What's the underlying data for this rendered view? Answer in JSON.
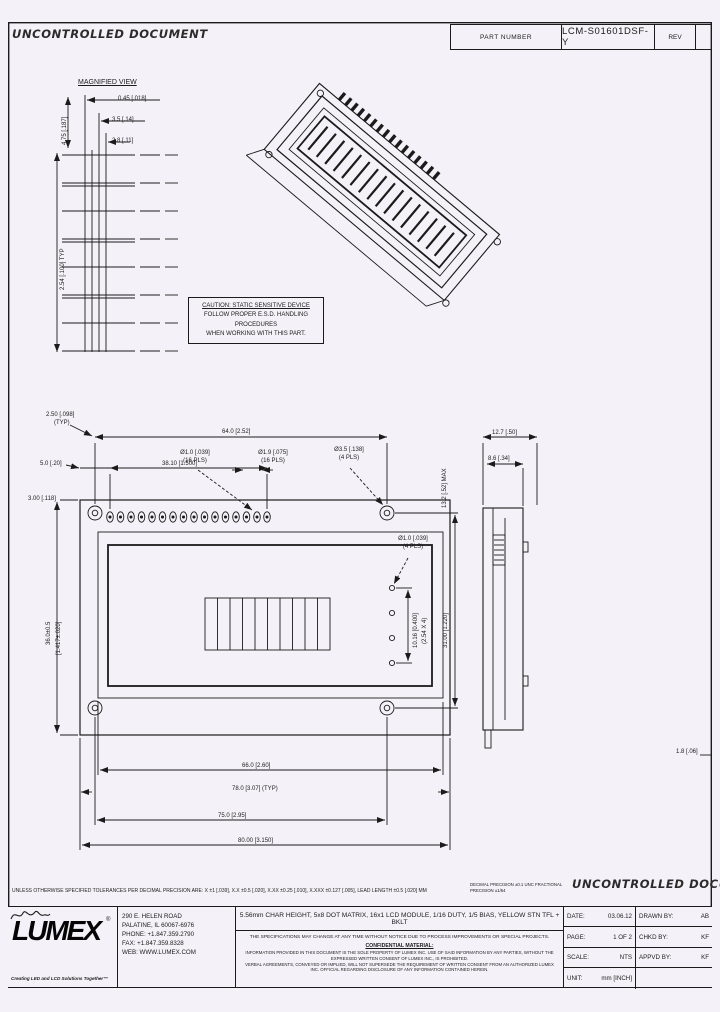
{
  "header": {
    "watermark": "UNCONTROLLED DOCUMENT",
    "part_number_label": "PART NUMBER",
    "part_number": "LCM-S01601DSF-Y",
    "rev_label": "REV",
    "rev_value": ""
  },
  "detail_view": {
    "title": "MAGNIFIED VIEW",
    "dim_pin_width": "0.45 [.018]",
    "dim_pin_a": "3.5 [.14]",
    "dim_pin_b": "2.8 [.11]",
    "dim_left_v": "4.75 [.187]",
    "dim_pitch_v": "2.54 [.100] TYP"
  },
  "caution": {
    "line1": "CAUTION: STATIC SENSITIVE DEVICE",
    "line2": "FOLLOW PROPER E.S.D. HANDLING PROCEDURES",
    "line3": "WHEN WORKING WITH THIS PART."
  },
  "front_view": {
    "dim_hole_offset": "2.50 [.098]",
    "dim_hole_offset_qty": "(TYP)",
    "dim_top_span": "64.0 [2.52]",
    "dim_pin1_offset": "5.0 [.20]",
    "dim_pin_row": "38.10 [1.500]",
    "dim_pin_hole": "Ø1.0 [.039]",
    "dim_pin_hole_qty": "(16 PLS)",
    "dim_pin_pad": "Ø1.9 [.075]",
    "dim_pin_pad_qty": "(16 PLS)",
    "dim_mount_hole": "Ø3.5 [.138]",
    "dim_mount_hole_qty": "(4 PLS)",
    "dim_thickness": "13.2 [.52] MAX",
    "dim_edge": "3.00 [.118]",
    "dim_height_a": "36.0±0.5",
    "dim_height_b": "[1.417±.020]",
    "dim_small_hole": "Ø1.0 [.039]",
    "dim_small_hole_qty": "(4 PLS)",
    "dim_hole_col_a": "10.16 [0.400]",
    "dim_hole_col_b": "(2.54 X 4)",
    "dim_hole_span_v": "31.00 [1.220]",
    "dim_bezel_w": "66.0 [2.60]",
    "dim_typ_w": "78.0 [3.07] (TYP)",
    "dim_hole_span_h": "75.0 [2.95]",
    "dim_overall_w": "80.00 [3.150]"
  },
  "side_view": {
    "dim_total_t": "12.7 [.50]",
    "dim_bezel_t": "8.6 [.34]",
    "dim_pcb_t": "1.8 [.06]"
  },
  "notes": {
    "tolerance": "UNLESS OTHERWISE SPECIFIED TOLERANCES PER DECIMAL PRECISION ARE: X ±1 [.039], X.X ±0.5 [.020], X.XX ±0.25 [.010], X.XXX ±0.127 [.005], LEAD LENGTH ±0.5 [.020] MM",
    "tolerance_extra": "DECIMAL PRECISION ±0.1  UNC  FRACTIONAL PRECISION ±1/64",
    "watermark": "UNCONTROLLED DOCUMENT"
  },
  "title_block": {
    "logo_text": "LUMEX",
    "logo_reg": "®",
    "tagline": "Creating LED and LCD Solutions Together™",
    "address": [
      "290 E. HELEN ROAD",
      "PALATINE, IL 60067-6976",
      "PHONE: +1.847.359.2790",
      "FAX: +1.847.359.8328",
      "WEB: WWW.LUMEX.COM"
    ],
    "description": "5.56mm CHAR HEIGHT, 5x8 DOT MATRIX, 16x1 LCD MODULE, 1/16 DUTY, 1/5 BIAS, YELLOW STN TFL + BKLT",
    "disclaimer": "THE SPECIFICATIONS MAY CHANGE AT ANY TIME WITHOUT NOTICE DUE TO PROCESS IMPROVEMENTS OR SPECIAL PROJECTS.",
    "confidential_heading": "CONFIDENTIAL MATERIAL:",
    "confidential_line1": "INFORMATION PROVIDED IN THIS DOCUMENT IS THE SOLE PROPERTY OF LUMEX INC. USE OF SAID INFORMATION BY ANY PARTIES, WITHOUT THE EXPRESSED WRITTEN CONSENT OF LUMEX INC., IS PROHIBITED.",
    "confidential_line2": "VERBAL AGREEMENTS, CONVEYED OR IMPLIED, WILL NOT SUPERSEDE THE REQUIREMENT OF WRITTEN CONSENT FROM AN AUTHORIZED LUMEX INC. OFFICIAL REGARDING DISCLOSURE OF ANY INFORMATION CONTAINED HEREIN.",
    "fields": {
      "date_label": "DATE:",
      "date_value": "03.06.12",
      "page_label": "PAGE:",
      "page_value": "1 OF 2",
      "scale_label": "SCALE:",
      "scale_value": "NTS",
      "unit_label": "UNIT:",
      "unit_value": "mm [INCH]",
      "drawn_label": "DRAWN BY:",
      "drawn_value": "AB",
      "chkd_label": "CHKD BY:",
      "chkd_value": "KF",
      "appvd_label": "APPVD BY:",
      "appvd_value": "KF"
    }
  }
}
